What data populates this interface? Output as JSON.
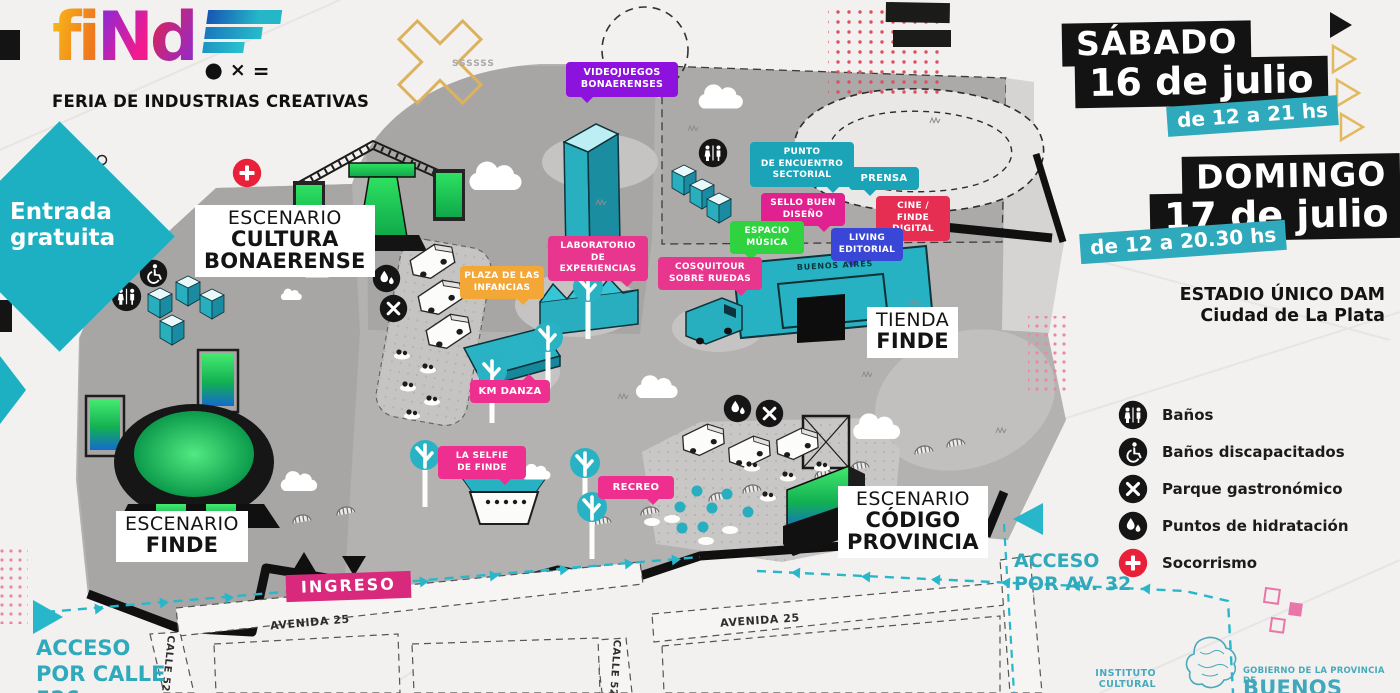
{
  "brand": {
    "letters": [
      "fi",
      "N",
      "d"
    ],
    "symbols": [
      "●",
      "×",
      "="
    ],
    "tagline": "FERIA DE INDUSTRIAS CREATIVAS"
  },
  "entrance": {
    "badge": "Entrada\ngratuita"
  },
  "schedule": {
    "saturday": {
      "day": "SÁBADO",
      "date": "16 de julio",
      "hours": "de 12 a 21 hs"
    },
    "sunday": {
      "day": "DOMINGO",
      "date": "17 de julio",
      "hours": "de 12 a 20.30 hs"
    }
  },
  "venue": {
    "name": "ESTADIO ÚNICO DAM",
    "city": "Ciudad de La Plata"
  },
  "legend": {
    "items": [
      {
        "label": "Baños",
        "icon": "restroom-icon",
        "color": "#151515"
      },
      {
        "label": "Baños discapacitados",
        "icon": "wheelchair-icon",
        "color": "#151515"
      },
      {
        "label": "Parque gastronómico",
        "icon": "food-park-icon",
        "color": "#151515"
      },
      {
        "label": "Puntos de hidratación",
        "icon": "hydration-icon",
        "color": "#151515"
      },
      {
        "label": "Socorrismo",
        "icon": "first-aid-icon",
        "color": "#e82039"
      }
    ]
  },
  "map": {
    "stage_labels": {
      "cultura": {
        "l1": "ESCENARIO",
        "l2": "CULTURA",
        "l3": "BONAERENSE"
      },
      "finde": {
        "l1": "ESCENARIO",
        "l2": "FINDE"
      },
      "codigo": {
        "l1": "ESCENARIO",
        "l2": "CÓDIGO",
        "l3": "PROVINCIA"
      },
      "tienda": {
        "l1": "TIENDA",
        "l2": "FINDE"
      }
    },
    "bubbles": [
      {
        "name": "videojuegos",
        "text": "VIDEOJUEGOS\nBONAERENSES",
        "color": "#8d12dd"
      },
      {
        "name": "punto-encuentro",
        "text": "PUNTO\nDE ENCUENTRO\nSECTORIAL",
        "color": "#1ba4b8"
      },
      {
        "name": "prensa",
        "text": "PRENSA",
        "color": "#1ba4b8"
      },
      {
        "name": "sello-buen-diseno",
        "text": "SELLO BUEN\nDISEÑO",
        "color": "#e0218f"
      },
      {
        "name": "cine-finde-digital",
        "text": "CINE / FINDE\nDIGITAL",
        "color": "#e62e52"
      },
      {
        "name": "espacio-musica",
        "text": "ESPACIO\nMÚSICA",
        "color": "#2fd23f"
      },
      {
        "name": "living-editorial",
        "text": "LIVING\nEDITORIAL",
        "color": "#3a46d6"
      },
      {
        "name": "laboratorio",
        "text": "LABORATORIO\nDE EXPERIENCIAS",
        "color": "#e8358d"
      },
      {
        "name": "plaza-infancias",
        "text": "PLAZA DE LAS\nINFANCIAS",
        "color": "#f2a737"
      },
      {
        "name": "cosquitour",
        "text": "COSQUITOUR\nSOBRE RUEDAS",
        "color": "#e8358d"
      },
      {
        "name": "km-danza",
        "text": "KM DANZA",
        "color": "#ee2f8f"
      },
      {
        "name": "la-selfie",
        "text": "LA SELFIE\nDE FINDE",
        "color": "#ee2f8f"
      },
      {
        "name": "recreo",
        "text": "RECREO",
        "color": "#ee2f8f"
      }
    ],
    "pavilion": "BUENOS AIRES",
    "ingreso": "INGRESO",
    "streets": {
      "avenida": "AVENIDA 25",
      "calle527": "CALLE 527",
      "calle528": "CALLE 528"
    },
    "access": {
      "av32": "ACCESO\nPOR AV. 32",
      "calle526": "ACCESO\nPOR CALLE\n526"
    }
  },
  "footer": {
    "institute": "INSTITUTO\nCULTURAL",
    "gov_line": "GOBIERNO DE LA PROVINCIA DE",
    "gov_name": "BUENOS AIRES"
  },
  "decor": {
    "stamp": "SSSSSS"
  },
  "colors": {
    "teal": "#28b7ca",
    "paper": "#f2f1ef",
    "ink": "#131313",
    "red": "#e82039",
    "pink": "#ee2f8f"
  }
}
